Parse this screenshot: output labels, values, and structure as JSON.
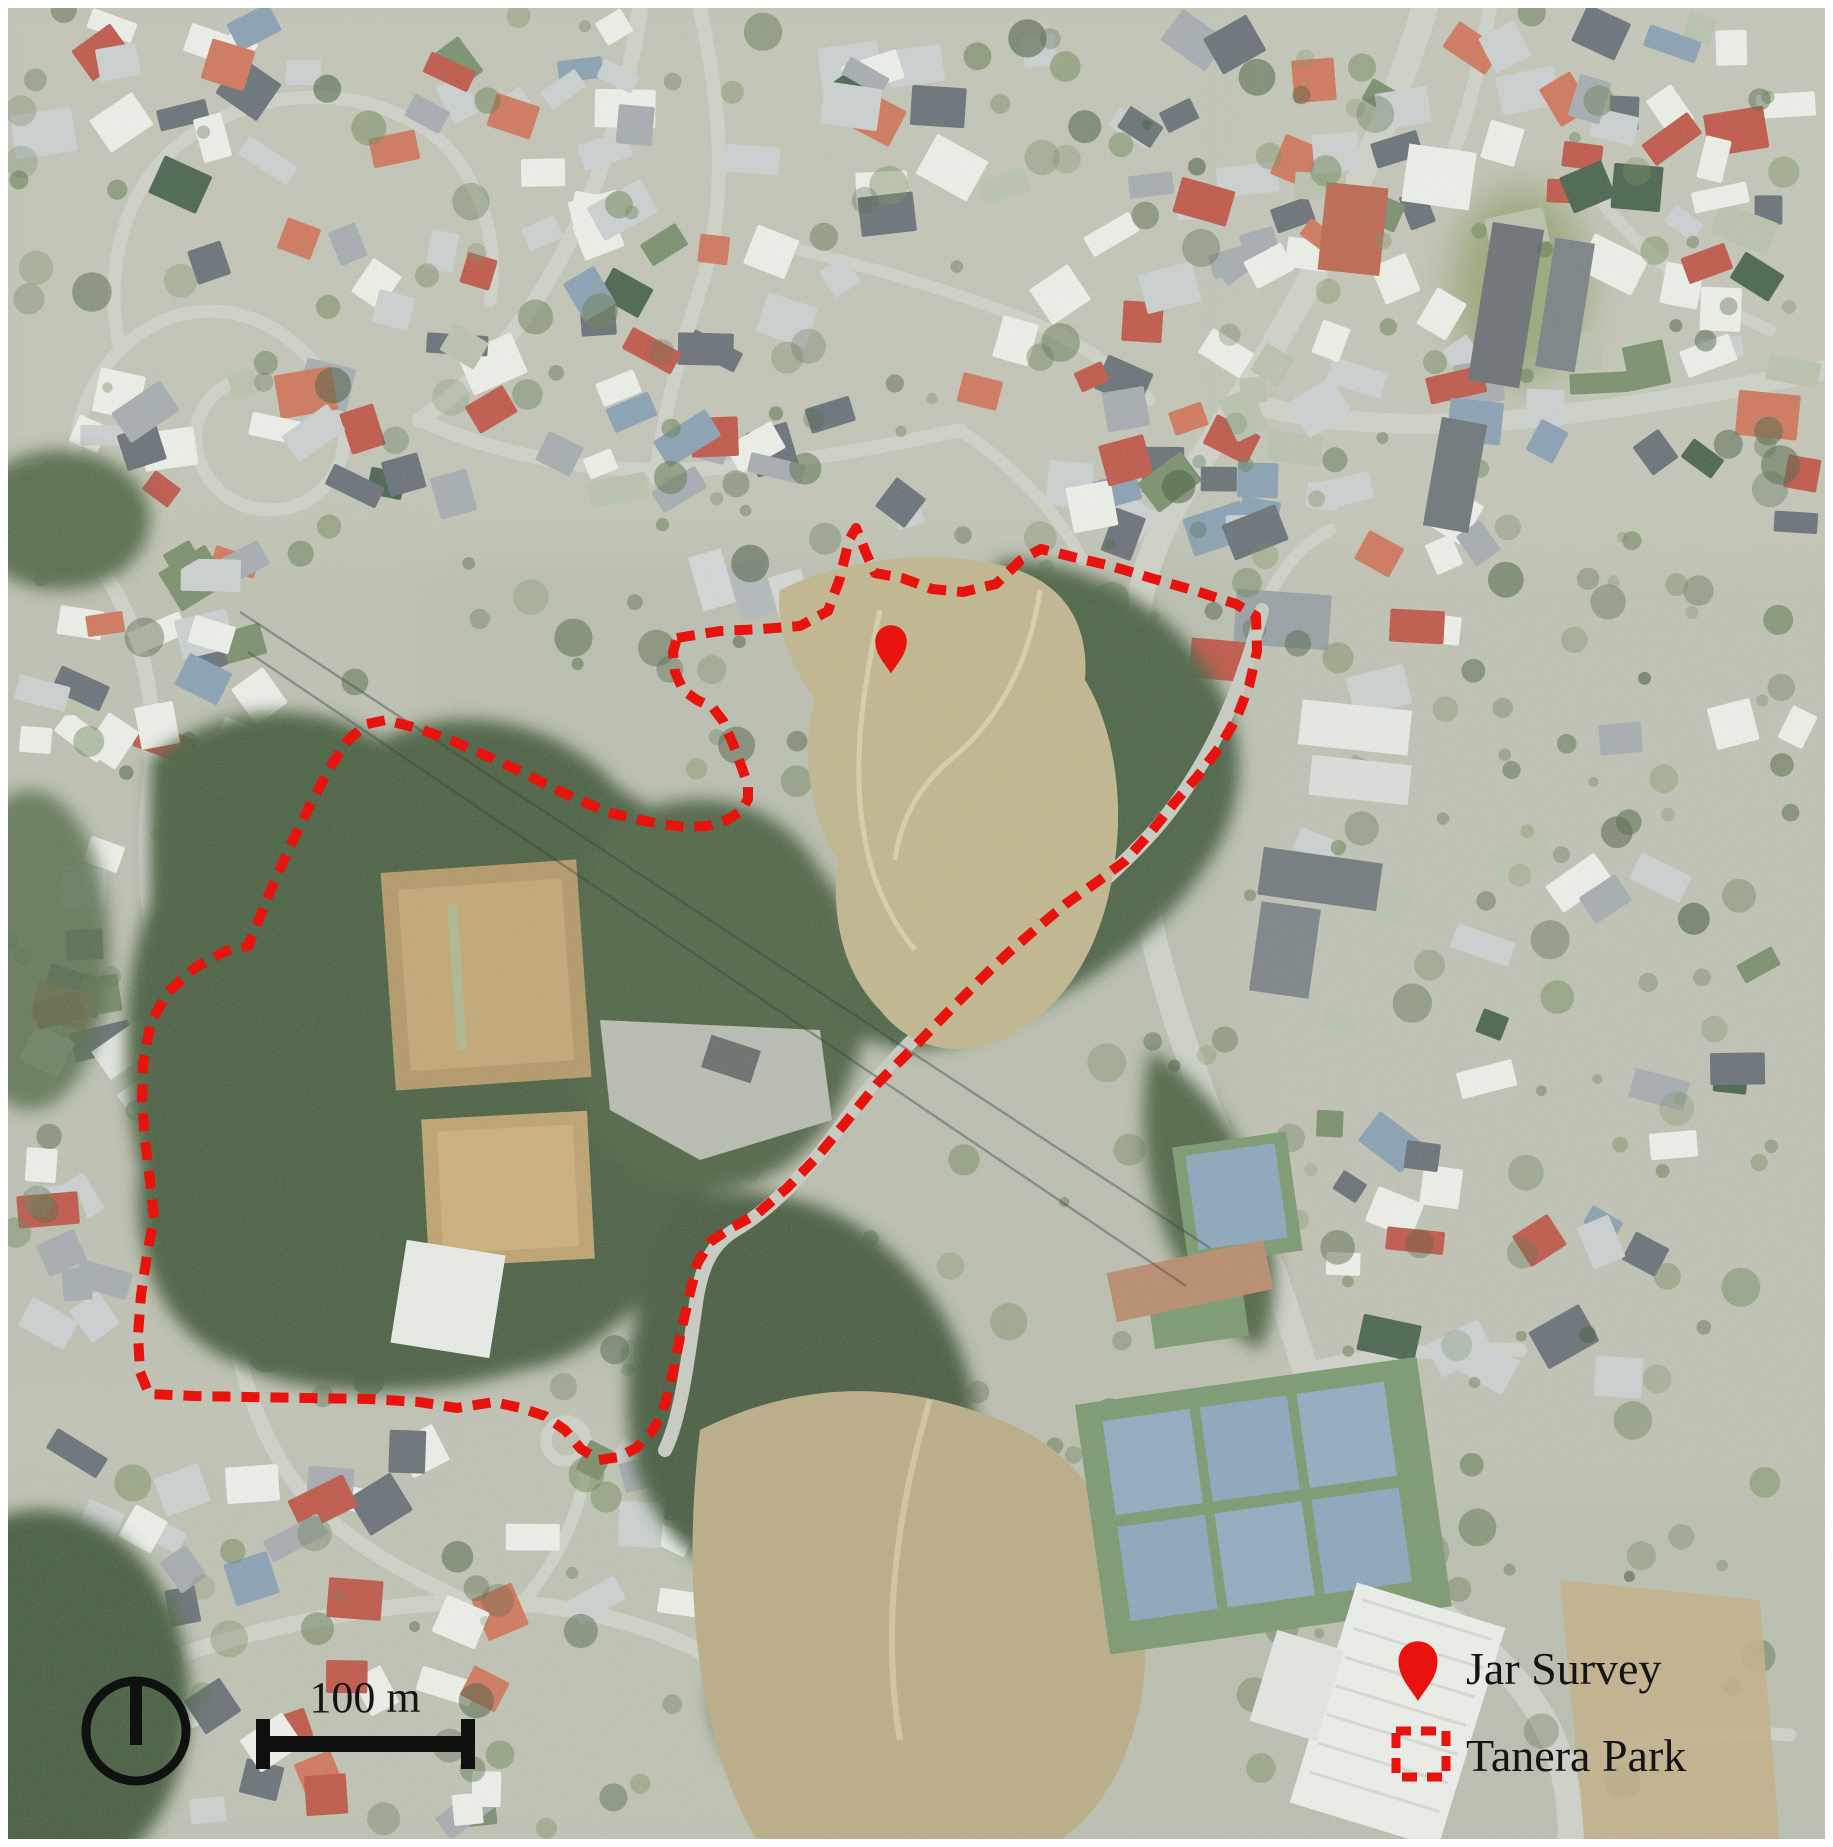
{
  "figure": {
    "kind": "aerial-photo map figure",
    "subject": "Tanera Park jar survey location"
  },
  "map": {
    "width": 1833,
    "height": 1847,
    "annotation_color": "#e7130c",
    "frame_color": "#ffffff"
  },
  "survey_pin": {
    "label": "Jar Survey",
    "x": 891,
    "y": 642
  },
  "park_boundary": {
    "label": "Tanera Park",
    "color": "#e7130c",
    "points": [
      [
        677,
        638
      ],
      [
        720,
        631
      ],
      [
        762,
        629
      ],
      [
        800,
        626
      ],
      [
        828,
        611
      ],
      [
        840,
        578
      ],
      [
        849,
        540
      ],
      [
        856,
        528
      ],
      [
        866,
        553
      ],
      [
        875,
        573
      ],
      [
        902,
        578
      ],
      [
        932,
        589
      ],
      [
        963,
        592
      ],
      [
        996,
        584
      ],
      [
        1021,
        560
      ],
      [
        1041,
        549
      ],
      [
        1073,
        557
      ],
      [
        1111,
        566
      ],
      [
        1151,
        578
      ],
      [
        1196,
        591
      ],
      [
        1236,
        604
      ],
      [
        1256,
        616
      ],
      [
        1257,
        651
      ],
      [
        1249,
        686
      ],
      [
        1237,
        717
      ],
      [
        1219,
        748
      ],
      [
        1197,
        777
      ],
      [
        1175,
        802
      ],
      [
        1151,
        832
      ],
      [
        1125,
        861
      ],
      [
        1097,
        882
      ],
      [
        1067,
        903
      ],
      [
        1037,
        928
      ],
      [
        1007,
        954
      ],
      [
        984,
        976
      ],
      [
        951,
        1009
      ],
      [
        914,
        1047
      ],
      [
        877,
        1084
      ],
      [
        846,
        1122
      ],
      [
        817,
        1157
      ],
      [
        787,
        1188
      ],
      [
        757,
        1214
      ],
      [
        729,
        1229
      ],
      [
        710,
        1242
      ],
      [
        697,
        1264
      ],
      [
        689,
        1297
      ],
      [
        681,
        1332
      ],
      [
        674,
        1367
      ],
      [
        667,
        1397
      ],
      [
        661,
        1416
      ],
      [
        651,
        1433
      ],
      [
        636,
        1448
      ],
      [
        619,
        1457
      ],
      [
        599,
        1460
      ],
      [
        581,
        1449
      ],
      [
        565,
        1430
      ],
      [
        545,
        1416
      ],
      [
        521,
        1408
      ],
      [
        494,
        1402
      ],
      [
        457,
        1408
      ],
      [
        419,
        1402
      ],
      [
        369,
        1399
      ],
      [
        309,
        1398
      ],
      [
        249,
        1397
      ],
      [
        194,
        1396
      ],
      [
        149,
        1394
      ],
      [
        140,
        1372
      ],
      [
        138,
        1335
      ],
      [
        141,
        1295
      ],
      [
        147,
        1255
      ],
      [
        154,
        1218
      ],
      [
        150,
        1180
      ],
      [
        145,
        1140
      ],
      [
        142,
        1100
      ],
      [
        143,
        1063
      ],
      [
        151,
        1022
      ],
      [
        168,
        992
      ],
      [
        196,
        967
      ],
      [
        226,
        951
      ],
      [
        248,
        946
      ],
      [
        258,
        922
      ],
      [
        274,
        882
      ],
      [
        295,
        836
      ],
      [
        314,
        797
      ],
      [
        331,
        766
      ],
      [
        348,
        740
      ],
      [
        367,
        724
      ],
      [
        386,
        720
      ],
      [
        420,
        729
      ],
      [
        455,
        742
      ],
      [
        489,
        757
      ],
      [
        520,
        771
      ],
      [
        551,
        787
      ],
      [
        581,
        801
      ],
      [
        611,
        813
      ],
      [
        640,
        820
      ],
      [
        661,
        824
      ],
      [
        684,
        827
      ],
      [
        707,
        826
      ],
      [
        727,
        820
      ],
      [
        741,
        811
      ],
      [
        748,
        799
      ],
      [
        748,
        786
      ],
      [
        742,
        768
      ],
      [
        733,
        744
      ],
      [
        723,
        721
      ],
      [
        713,
        708
      ],
      [
        697,
        700
      ],
      [
        683,
        690
      ],
      [
        675,
        672
      ],
      [
        673,
        652
      ]
    ]
  },
  "legend": {
    "items": [
      {
        "symbol": "pin-icon",
        "label": "Jar Survey"
      },
      {
        "symbol": "dashed-square-icon",
        "label": "Tanera Park"
      }
    ]
  },
  "scale_bar": {
    "label": "100 m"
  },
  "north_arrow": {
    "symbol": "circle-with-bar"
  }
}
